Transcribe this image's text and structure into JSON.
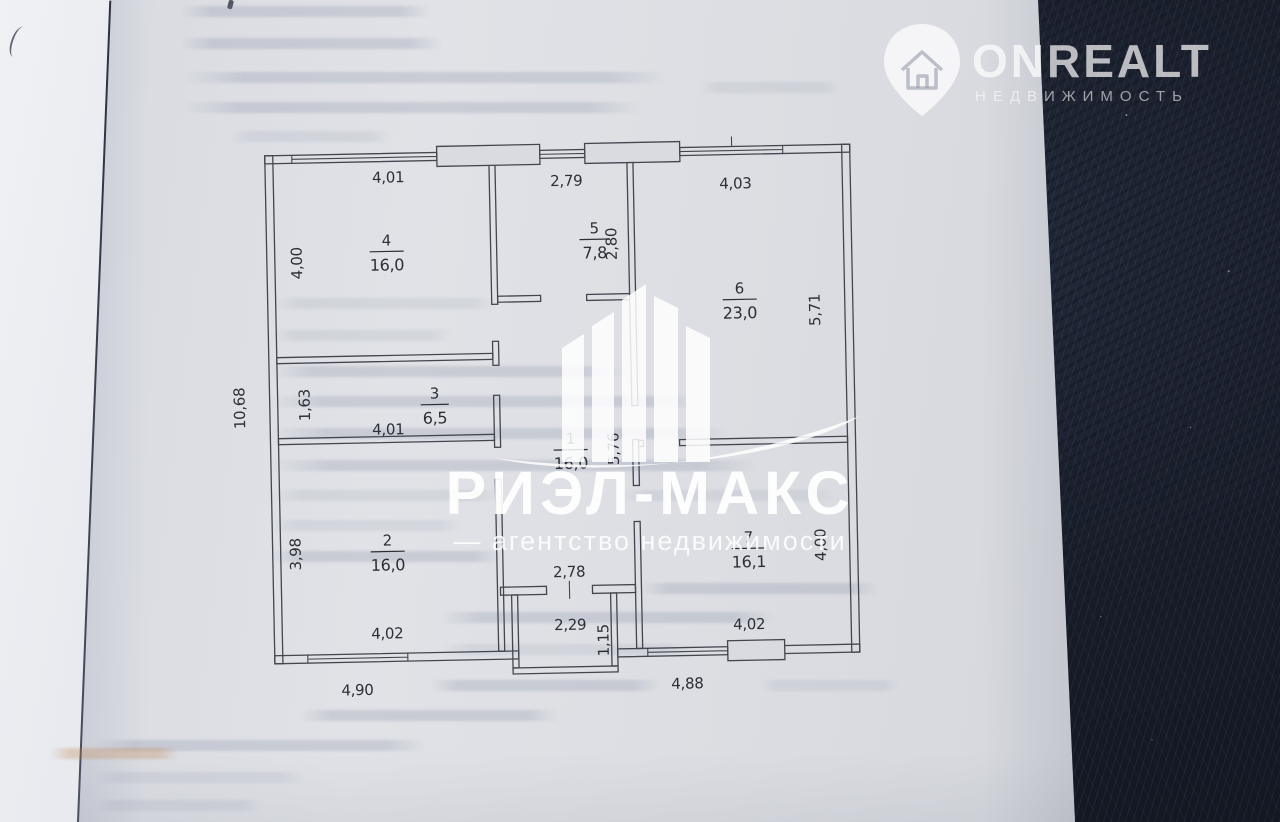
{
  "watermarks": {
    "rielmax": {
      "brand": "РИЭЛ-МАКС",
      "subtitle": "— агентство недвижимости"
    },
    "onrealt": {
      "brand": "ONREALT",
      "subtitle": "НЕДВИЖИМОСТЬ"
    }
  },
  "floor_plan": {
    "room1": {
      "number": "1",
      "area": "16,0",
      "width": "2,78",
      "height": "5,76"
    },
    "room2": {
      "number": "2",
      "area": "16,0",
      "width": "4,02",
      "height": "3,98"
    },
    "room3": {
      "number": "3",
      "area": "6,5",
      "width": "4,01",
      "height": "1,63"
    },
    "room4": {
      "number": "4",
      "area": "16,0",
      "width": "4,01",
      "height": "4,00"
    },
    "room5": {
      "number": "5",
      "area": "7,8",
      "width": "2,79",
      "height": "2,80"
    },
    "room6": {
      "number": "6",
      "area": "23,0",
      "width": "4,03",
      "height": "5,71"
    },
    "room7": {
      "number": "7",
      "area": "16,1",
      "width": "4,02",
      "height": "4,00"
    },
    "exterior": {
      "left_height": "10,68",
      "bottom_left_width": "4,90",
      "bottom_right_width": "4,88"
    },
    "entrance": {
      "door_width": "2,29",
      "porch_depth": "1,15"
    }
  },
  "colors": {
    "paper": "#dcdee3",
    "fabric_background": "#151a23",
    "plan_lines": "#43464f",
    "watermark": "#ffffff"
  }
}
